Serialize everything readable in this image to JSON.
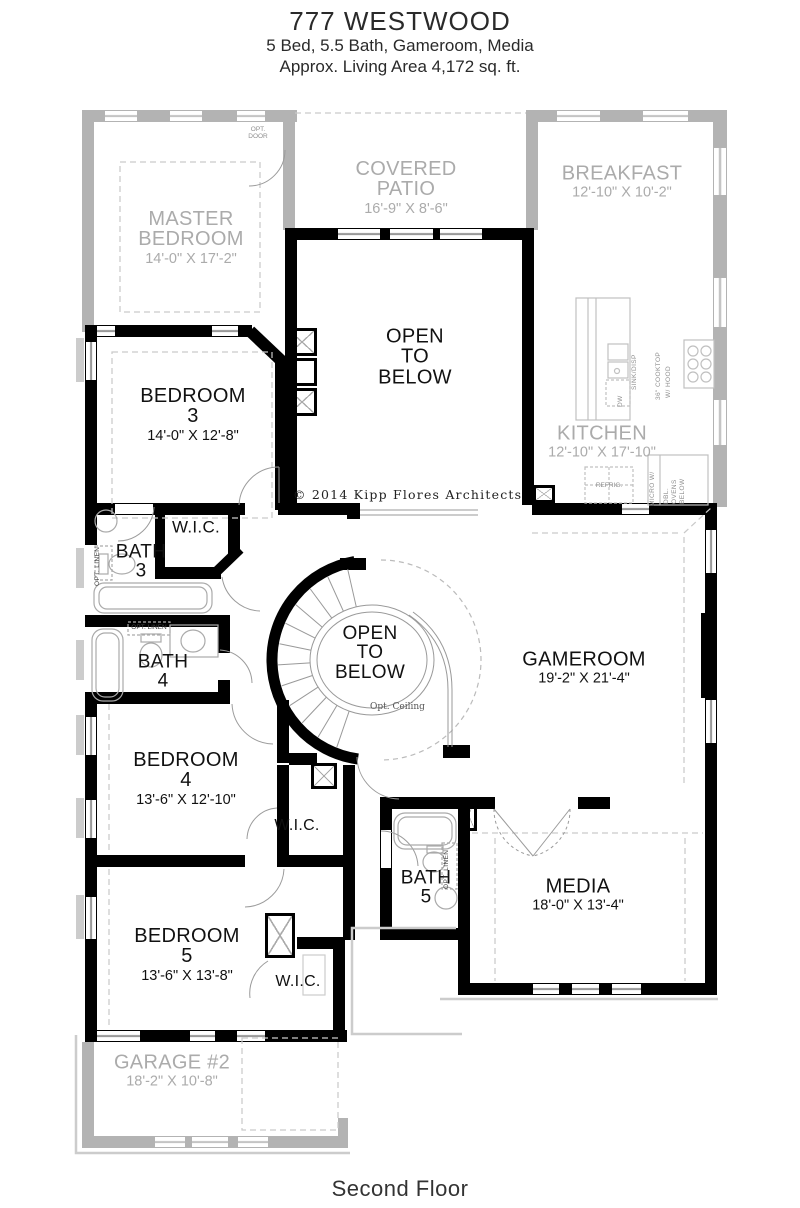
{
  "header": {
    "plan_name": "777 WESTWOOD",
    "subtitle": "5 Bed, 5.5 Bath, Gameroom, Media",
    "living_area": "Approx. Living Area 4,172 sq. ft."
  },
  "footer": {
    "floor_label": "Second Floor"
  },
  "copyright_text": "© 2014 Kipp Flores Architects",
  "rooms": {
    "master_bedroom": {
      "lines": [
        "MASTER",
        "BEDROOM"
      ],
      "dims": "14'-0\" X 17'-2\""
    },
    "covered_patio": {
      "lines": [
        "COVERED",
        "PATIO"
      ],
      "dims": "16'-9\" X 8'-6\""
    },
    "breakfast": {
      "lines": [
        "BREAKFAST"
      ],
      "dims": "12'-10\" X 10'-2\""
    },
    "kitchen": {
      "lines": [
        "KITCHEN"
      ],
      "dims": "12'-10\" X 17'-10\""
    },
    "open_to_below_upper": {
      "lines": [
        "OPEN",
        "TO",
        "BELOW"
      ]
    },
    "bedroom_3": {
      "lines": [
        "BEDROOM",
        "3"
      ],
      "dims": "14'-0\" X 12'-8\""
    },
    "wic_bath_3": {
      "lines": [
        "W.I.C."
      ]
    },
    "bath_3": {
      "lines": [
        "BATH",
        "3"
      ]
    },
    "bath_4": {
      "lines": [
        "BATH",
        "4"
      ]
    },
    "open_to_below_stair": {
      "lines": [
        "OPEN",
        "TO",
        "BELOW"
      ],
      "note": "Opt. Ceiling"
    },
    "gameroom": {
      "lines": [
        "GAMEROOM"
      ],
      "dims": "19'-2\" X 21'-4\""
    },
    "bedroom_4": {
      "lines": [
        "BEDROOM",
        "4"
      ],
      "dims": "13'-6\" X 12'-10\""
    },
    "wic_bedroom_4": {
      "lines": [
        "W.I.C."
      ]
    },
    "bath_5": {
      "lines": [
        "BATH",
        "5"
      ]
    },
    "media": {
      "lines": [
        "MEDIA"
      ],
      "dims": "18'-0\" X 13'-4\""
    },
    "bedroom_5": {
      "lines": [
        "BEDROOM",
        "5"
      ],
      "dims": "13'-6\" X 13'-8\""
    },
    "wic_bedroom_5": {
      "lines": [
        "W.I.C."
      ]
    },
    "garage_2": {
      "lines": [
        "GARAGE #2"
      ],
      "dims": "18'-2\" X 10'-8\""
    }
  },
  "annotations": {
    "opt_door_lines": [
      "OPT.",
      "DOOR"
    ],
    "opt_linen": "OPT. LINEN",
    "opt_ceiling": "Opt. Ceiling",
    "sink_disp": "SINK/DISP",
    "dw": "DW",
    "cooktop_lines": [
      "36\" COOKTOP",
      "W/ HOOD"
    ],
    "refrig": "REFRIG.",
    "micro": "MICRO W/",
    "ovens_lines": [
      "DBL.",
      "OVENS",
      "BELOW"
    ]
  },
  "colors": {
    "wall": "#000000",
    "ghost": "#b3b3b3",
    "annotation_gray": "#8e8e8e"
  }
}
